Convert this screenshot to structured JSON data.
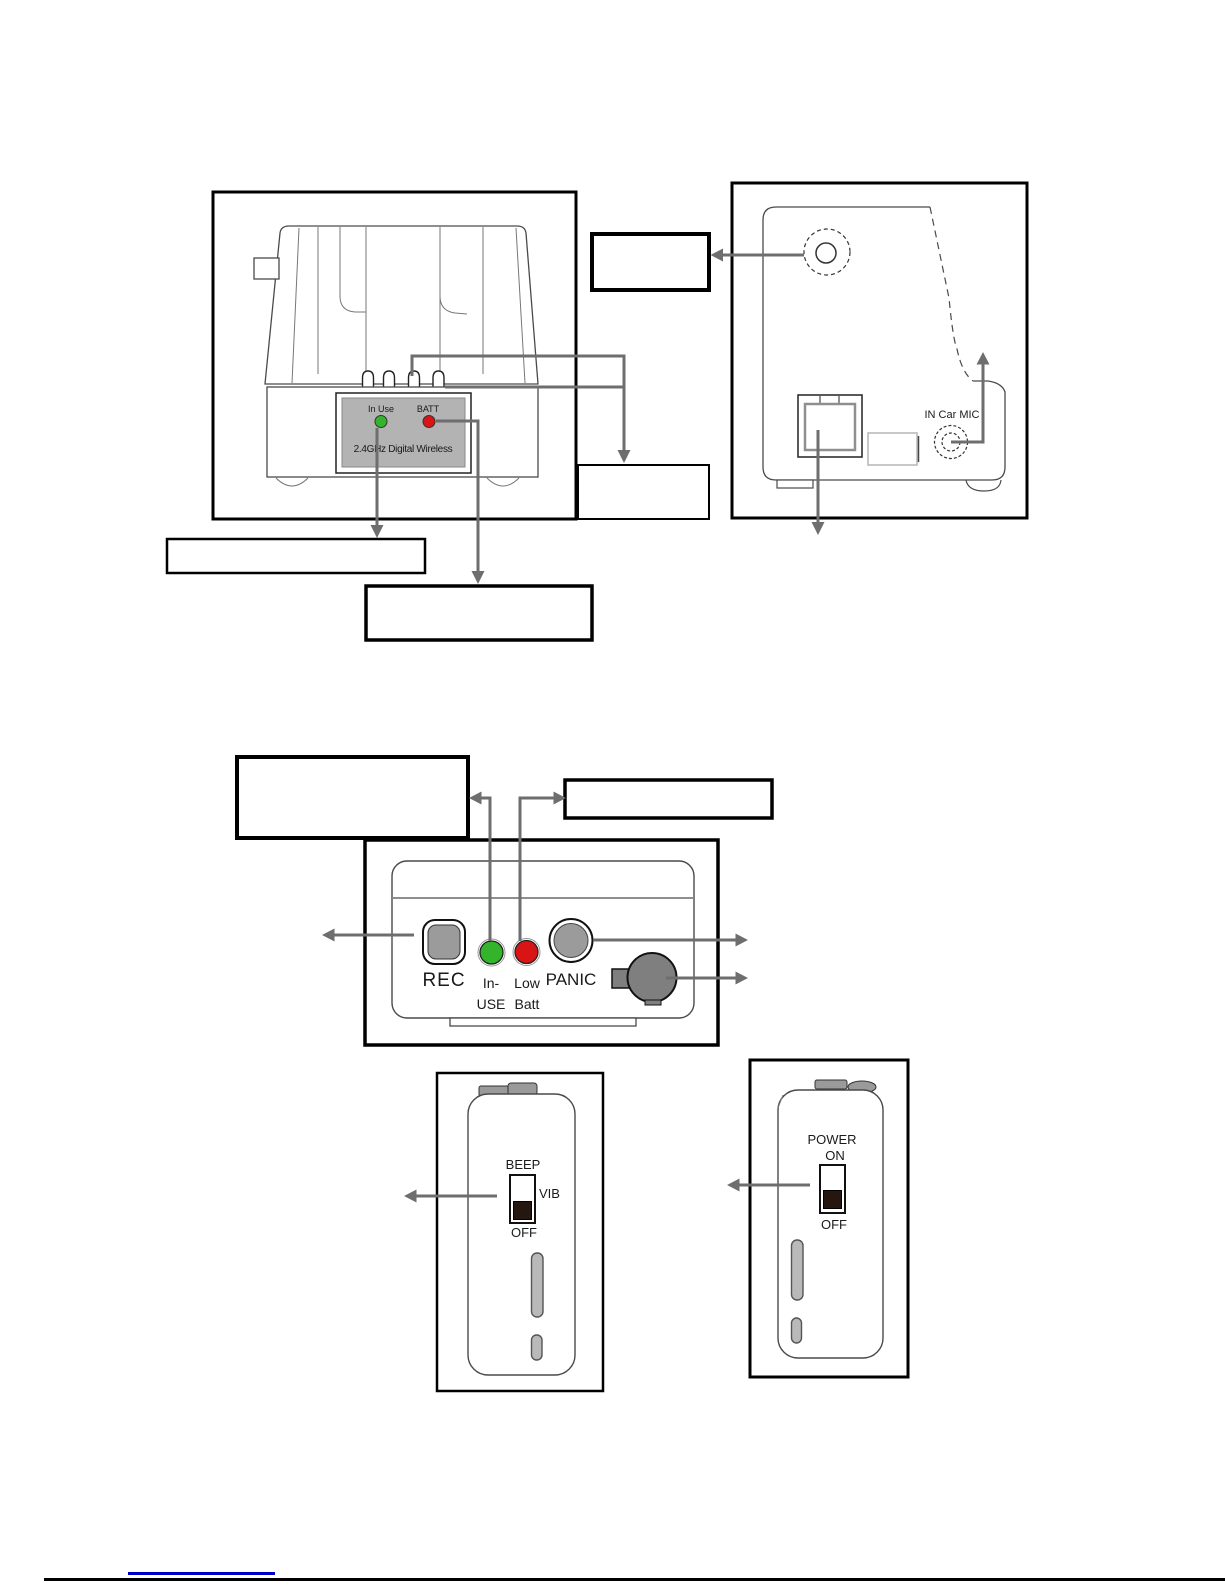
{
  "figures": {
    "cradle_front": {
      "in_use": "In Use",
      "batt": "BATT",
      "brand": "2.4GHz Digital Wireless"
    },
    "cradle_back": {
      "in_car_mic": "IN Car MIC"
    },
    "handset_front": {
      "rec": "REC",
      "in_use_line1": "In-",
      "in_use_line2": "USE",
      "low_batt_line1": "Low",
      "low_batt_line2": "Batt",
      "panic": "PANIC"
    },
    "handset_side_beep": {
      "beep": "BEEP",
      "vib": "VIB",
      "off": "OFF"
    },
    "handset_side_power": {
      "power": "POWER",
      "on": "ON",
      "off": "OFF"
    }
  },
  "colors": {
    "arrow_gray": "#6e6e6e",
    "led_green": "#33b42b",
    "led_red": "#d91414",
    "button_gray": "#9b9b9b",
    "knob_gray": "#7f7f7f",
    "plate_gray": "#b3b3b3",
    "switch_knob": "#251710",
    "clip_gray": "#9a9a9a",
    "slot_gray": "#b9b9b9",
    "footer_link": "#0000cc"
  }
}
